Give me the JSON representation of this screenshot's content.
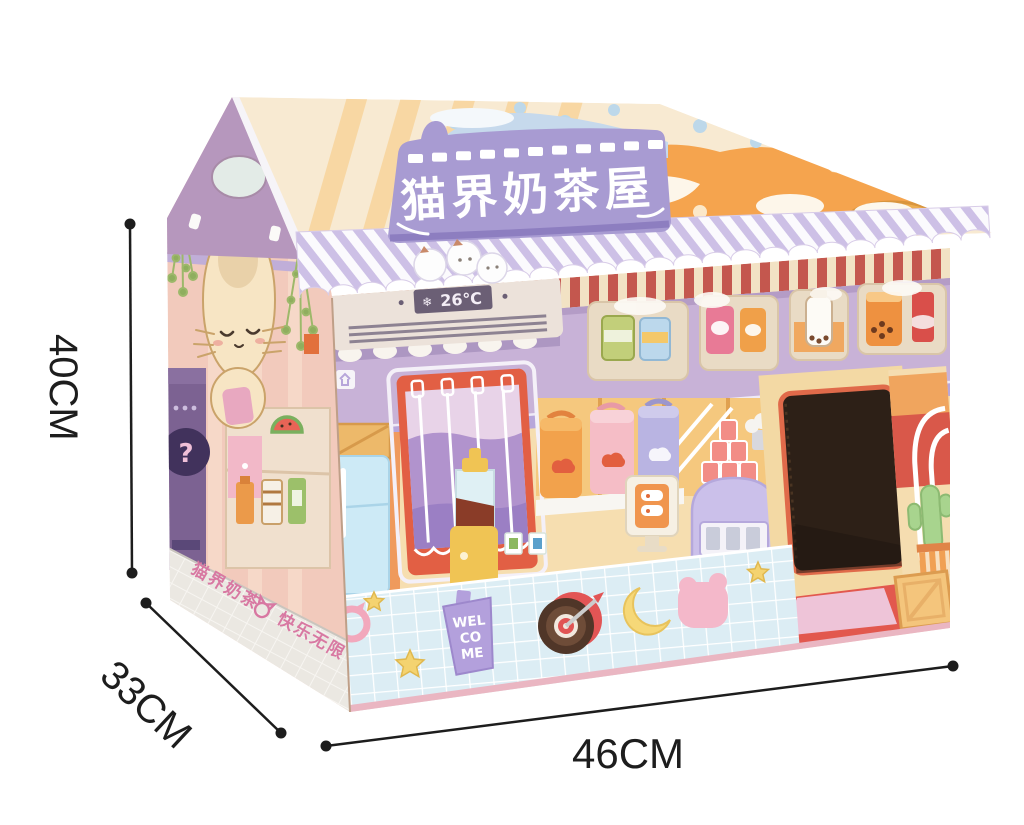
{
  "meta": {
    "description": "Product photo of a cardboard cat house styled as a milk-tea shop, annotated with its dimensions",
    "background": "#ffffff"
  },
  "dimensions": {
    "height": "40CM",
    "depth": "33CM",
    "width": "46CM"
  },
  "house": {
    "sign": {
      "text": "猫界奶茶屋"
    },
    "ac": {
      "icon": "snowflake-icon",
      "icon_glyph": "❄",
      "temperature": "26℃"
    },
    "counter": {
      "welcome_sign": {
        "lines": [
          "WEL",
          "CO",
          "ME"
        ]
      },
      "stickers": [
        "cat-head-ring",
        "star",
        "boba-welcome-cup",
        "dartboard",
        "crescent-moon",
        "pink-cat",
        "star"
      ]
    },
    "side": {
      "skirt_text_left": "猫界奶茶",
      "skirt_text_right": "快乐无限",
      "vending_question": "?"
    },
    "palette": {
      "sign_purple": "#a89bd2",
      "roof_cream": "#f8ead2",
      "roof_orange": "#f5a44e",
      "awning_stripe": "#cdc0e6",
      "wall_purple": "#c8b2d7",
      "wall_stripe_red": "#c4574e",
      "interior_cream": "#f6deb0",
      "counter_tile": "#dcedf4",
      "side_pink": "#f2cabc",
      "cat_cream": "#f7e5c4",
      "entrance_dark": "#2d2017",
      "dimension_line": "#1d1d1d"
    }
  }
}
